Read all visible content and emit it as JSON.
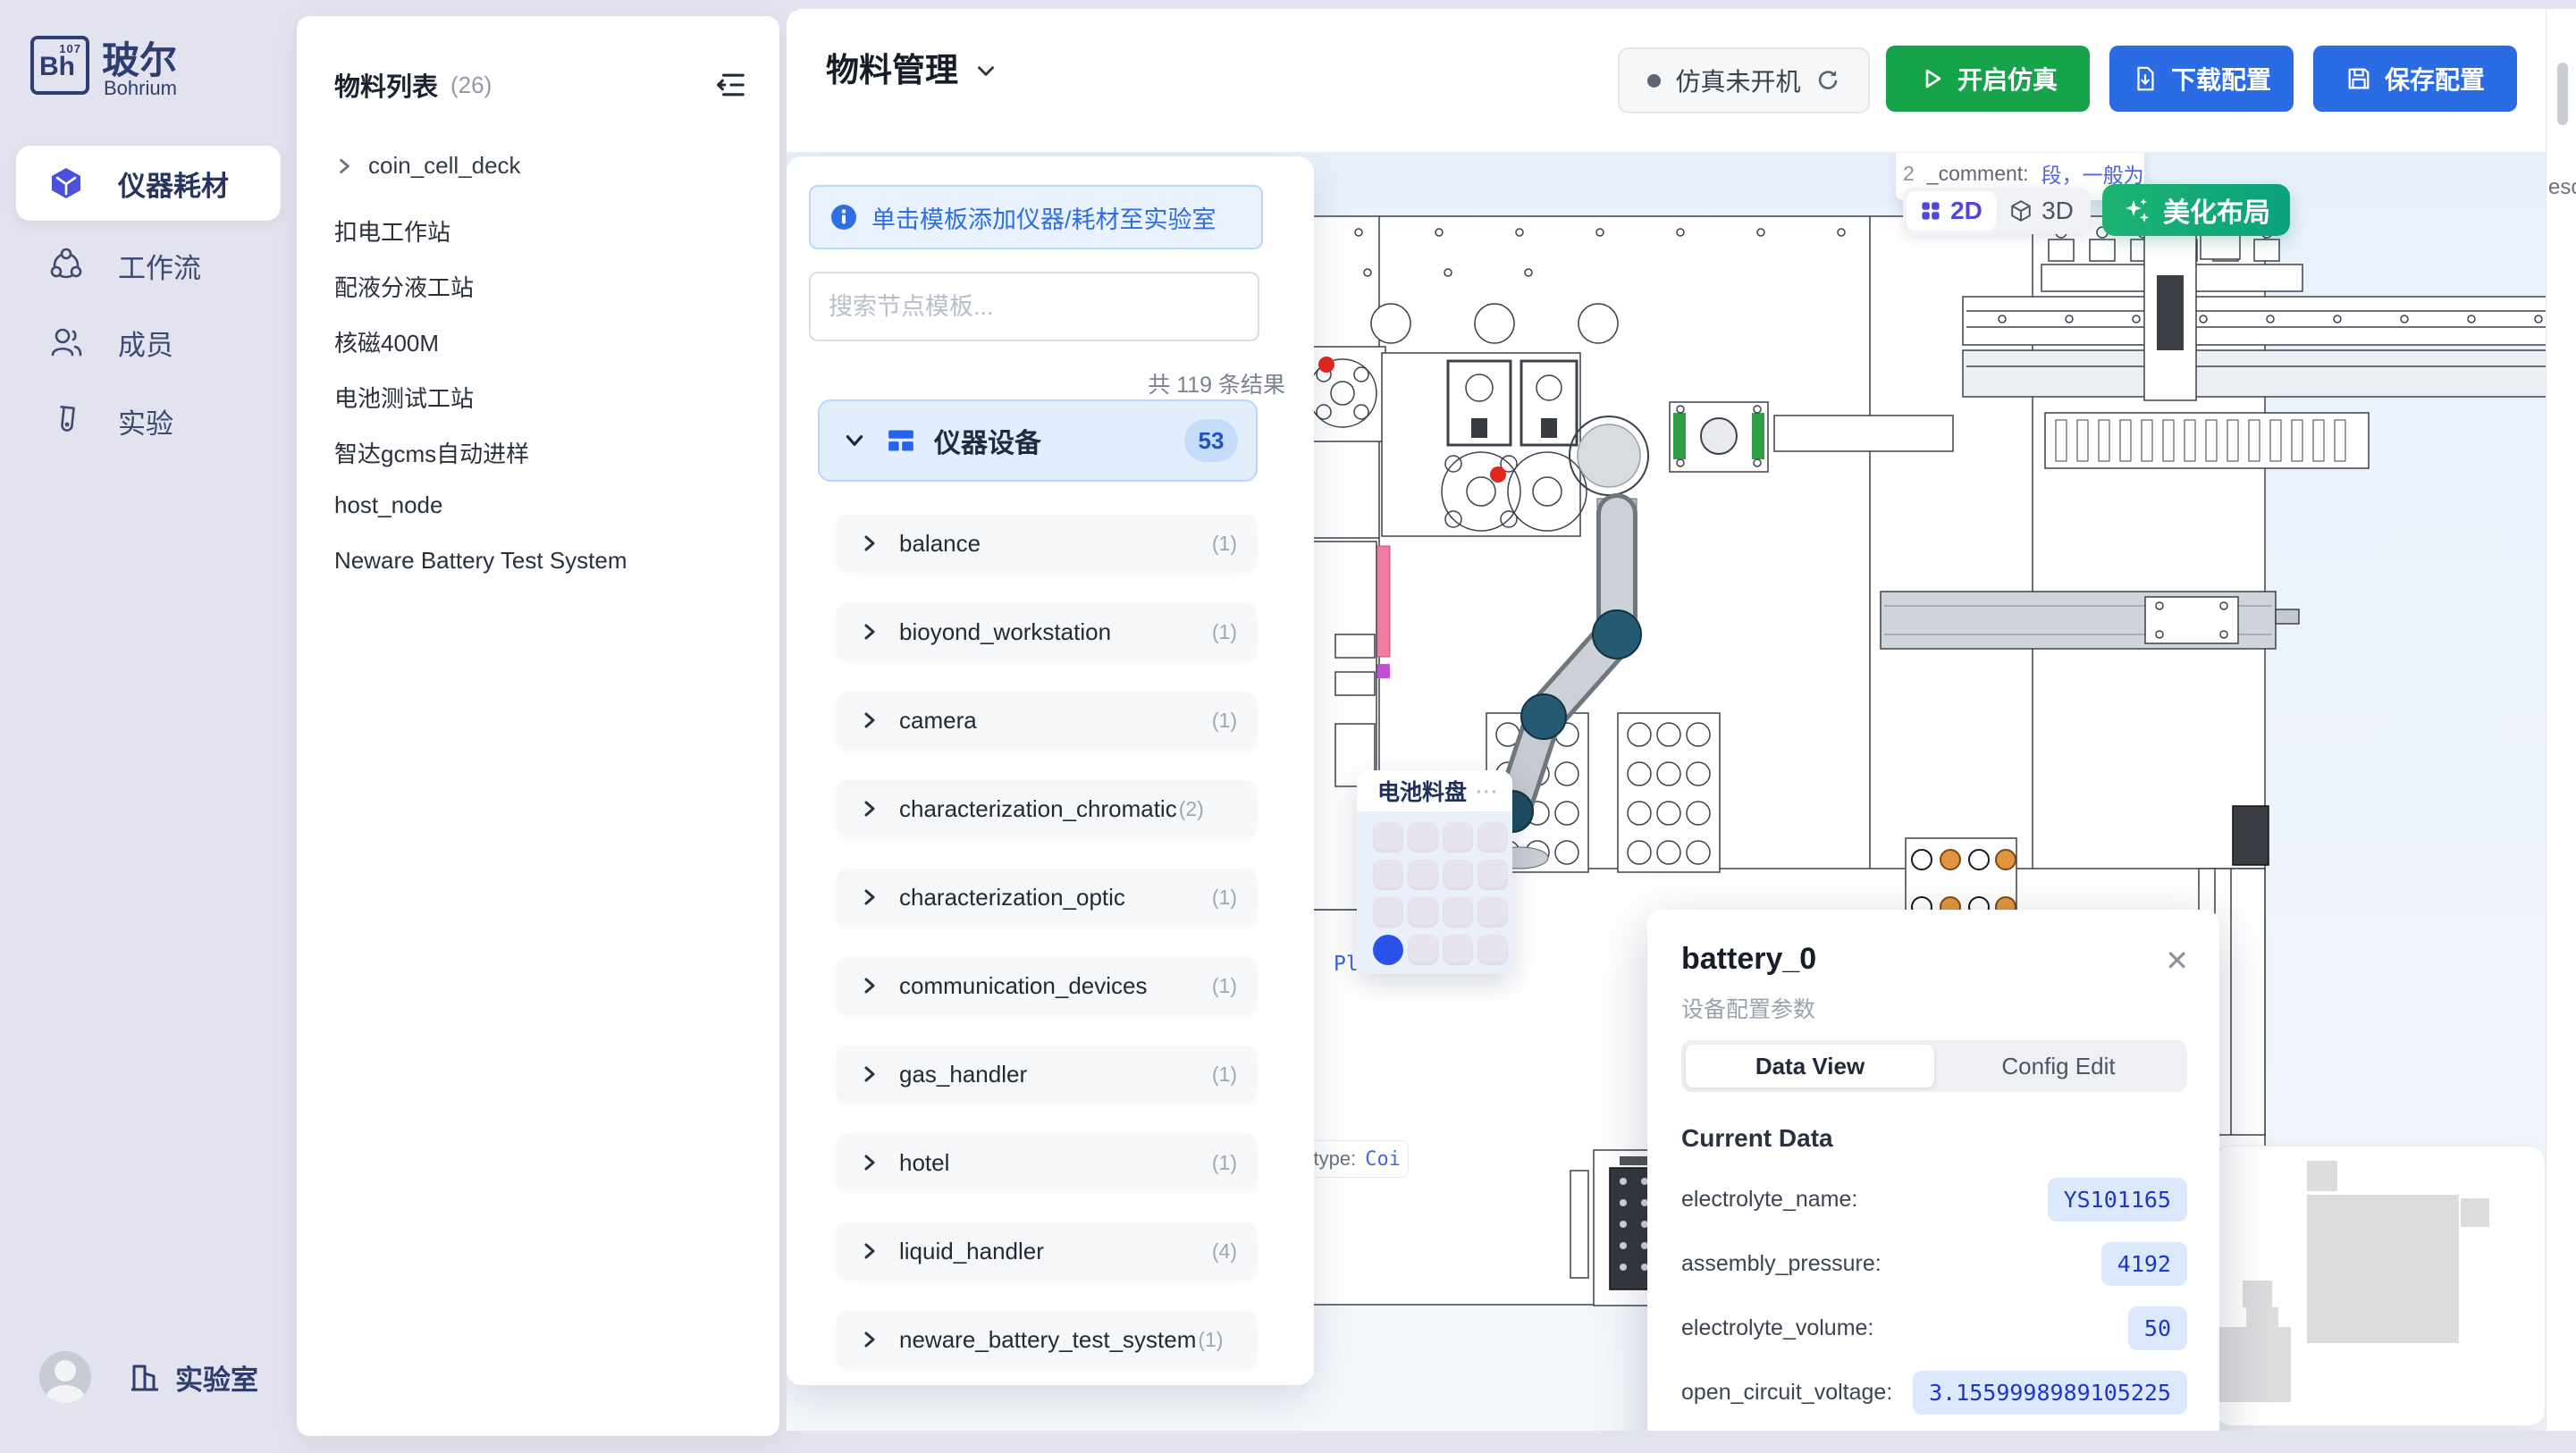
{
  "sidebar": {
    "logo": {
      "symbol": "Bh",
      "number": "107",
      "title": "玻尔",
      "subtitle": "Bohrium"
    },
    "items": [
      {
        "label": "仪器耗材"
      },
      {
        "label": "工作流"
      },
      {
        "label": "成员"
      },
      {
        "label": "实验"
      }
    ],
    "footer": {
      "lab": "实验室"
    }
  },
  "material_list": {
    "title": "物料列表",
    "count": "(26)",
    "tree_item": "coin_cell_deck",
    "items": [
      "扣电工作站",
      "配液分液工站",
      "核磁400M",
      "电池测试工站",
      "智达gcms自动进样",
      "host_node",
      "Neware Battery Test System"
    ]
  },
  "header": {
    "title": "物料管理",
    "status_label": "仿真未开机",
    "start_sim": "开启仿真",
    "download_config": "下载配置",
    "save_config": "保存配置"
  },
  "template_panel": {
    "banner": "单击模板添加仪器/耗材至实验室",
    "search_placeholder": "搜索节点模板...",
    "result_count": "共 119 条结果",
    "category": {
      "label": "仪器设备",
      "badge": "53"
    },
    "items": [
      {
        "label": "balance",
        "count": "(1)"
      },
      {
        "label": "bioyond_workstation",
        "count": "(1)"
      },
      {
        "label": "camera",
        "count": "(1)"
      },
      {
        "label": "characterization_chromatic",
        "count": "(2)"
      },
      {
        "label": "characterization_optic",
        "count": "(1)"
      },
      {
        "label": "communication_devices",
        "count": "(1)"
      },
      {
        "label": "gas_handler",
        "count": "(1)"
      },
      {
        "label": "hotel",
        "count": "(1)"
      },
      {
        "label": "liquid_handler",
        "count": "(4)"
      },
      {
        "label": "neware_battery_test_system",
        "count": "(1)"
      }
    ]
  },
  "canvas": {
    "toggle": {
      "d2": "2D",
      "d3": "3D"
    },
    "beautify": "美化布局",
    "comment_tooltip": {
      "prefix": "2",
      "key": "_comment:",
      "value": "段，一般为空，stat"
    },
    "type_tooltip": {
      "key": "type:",
      "value": "Coi"
    },
    "plate_label": "Plate",
    "flyout_fragment": "esou",
    "tray_card": {
      "title": "电池料盘",
      "menu": "⋯"
    }
  },
  "popup": {
    "title": "battery_0",
    "subtitle": "设备配置参数",
    "tab_data": "Data View",
    "tab_config": "Config Edit",
    "section": "Current Data",
    "close": "✕",
    "fields": [
      {
        "label": "electrolyte_name:",
        "value": "YS101165"
      },
      {
        "label": "assembly_pressure:",
        "value": "4192"
      },
      {
        "label": "electrolyte_volume:",
        "value": "50"
      },
      {
        "label": "open_circuit_voltage:",
        "value": "3.1559998989105225"
      },
      {
        "label": "data_electrolyte_code:",
        "value": "LG000014"
      }
    ]
  }
}
